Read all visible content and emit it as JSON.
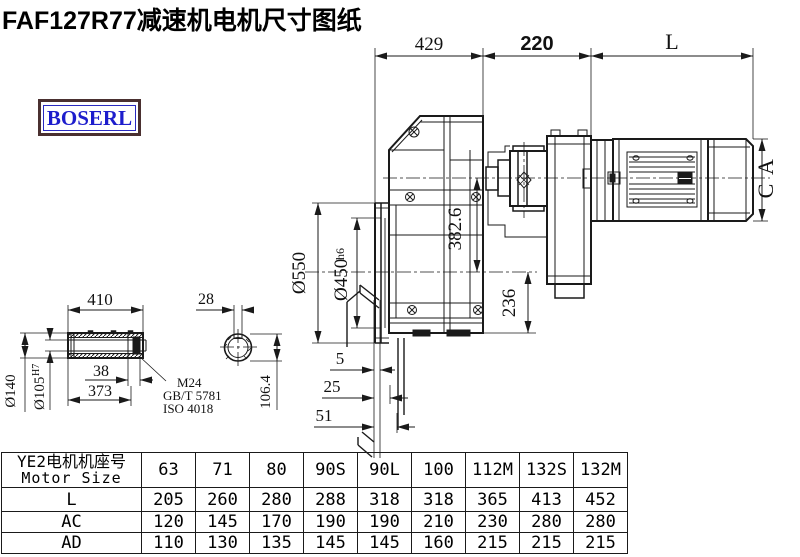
{
  "title": "FAF127R77减速机电机尺寸图纸",
  "logo": {
    "text": "BOSERL"
  },
  "dims": {
    "top_width": "429",
    "top_gap": "220",
    "motor_len": "L",
    "ac1": "A",
    "ac2": "C",
    "axis_to_out": "382.6",
    "out_to_base": "236",
    "flange_od": "Ø550",
    "spigot": "Ø450",
    "spigot_tol": "h6",
    "off_a": "5",
    "off_b": "25",
    "off_c": "51",
    "shaft_len": "410",
    "shaft_od": "Ø140",
    "bore": "Ø105",
    "bore_tol": "H7",
    "cap_len": "38",
    "inner_len": "373",
    "key_w": "28",
    "key_h": "106.4",
    "note1": "M24",
    "note2": "GB/T 5781",
    "note3": "ISO 4018"
  },
  "table": {
    "header_cn": "YE2电机机座号",
    "header_en": "Motor Size",
    "columns": [
      "63",
      "71",
      "80",
      "90S",
      "90L",
      "100",
      "112M",
      "132S",
      "132M"
    ],
    "rows": [
      {
        "label": "L",
        "values": [
          "205",
          "260",
          "280",
          "288",
          "318",
          "318",
          "365",
          "413",
          "452"
        ]
      },
      {
        "label": "AC",
        "values": [
          "120",
          "145",
          "170",
          "190",
          "190",
          "210",
          "230",
          "280",
          "280"
        ]
      },
      {
        "label": "AD",
        "values": [
          "110",
          "130",
          "135",
          "145",
          "145",
          "160",
          "215",
          "215",
          "215"
        ]
      }
    ]
  },
  "colors": {
    "line": "#1a1a1a",
    "logo_text": "#1d1dcc",
    "logo_border": "#4a3030"
  }
}
